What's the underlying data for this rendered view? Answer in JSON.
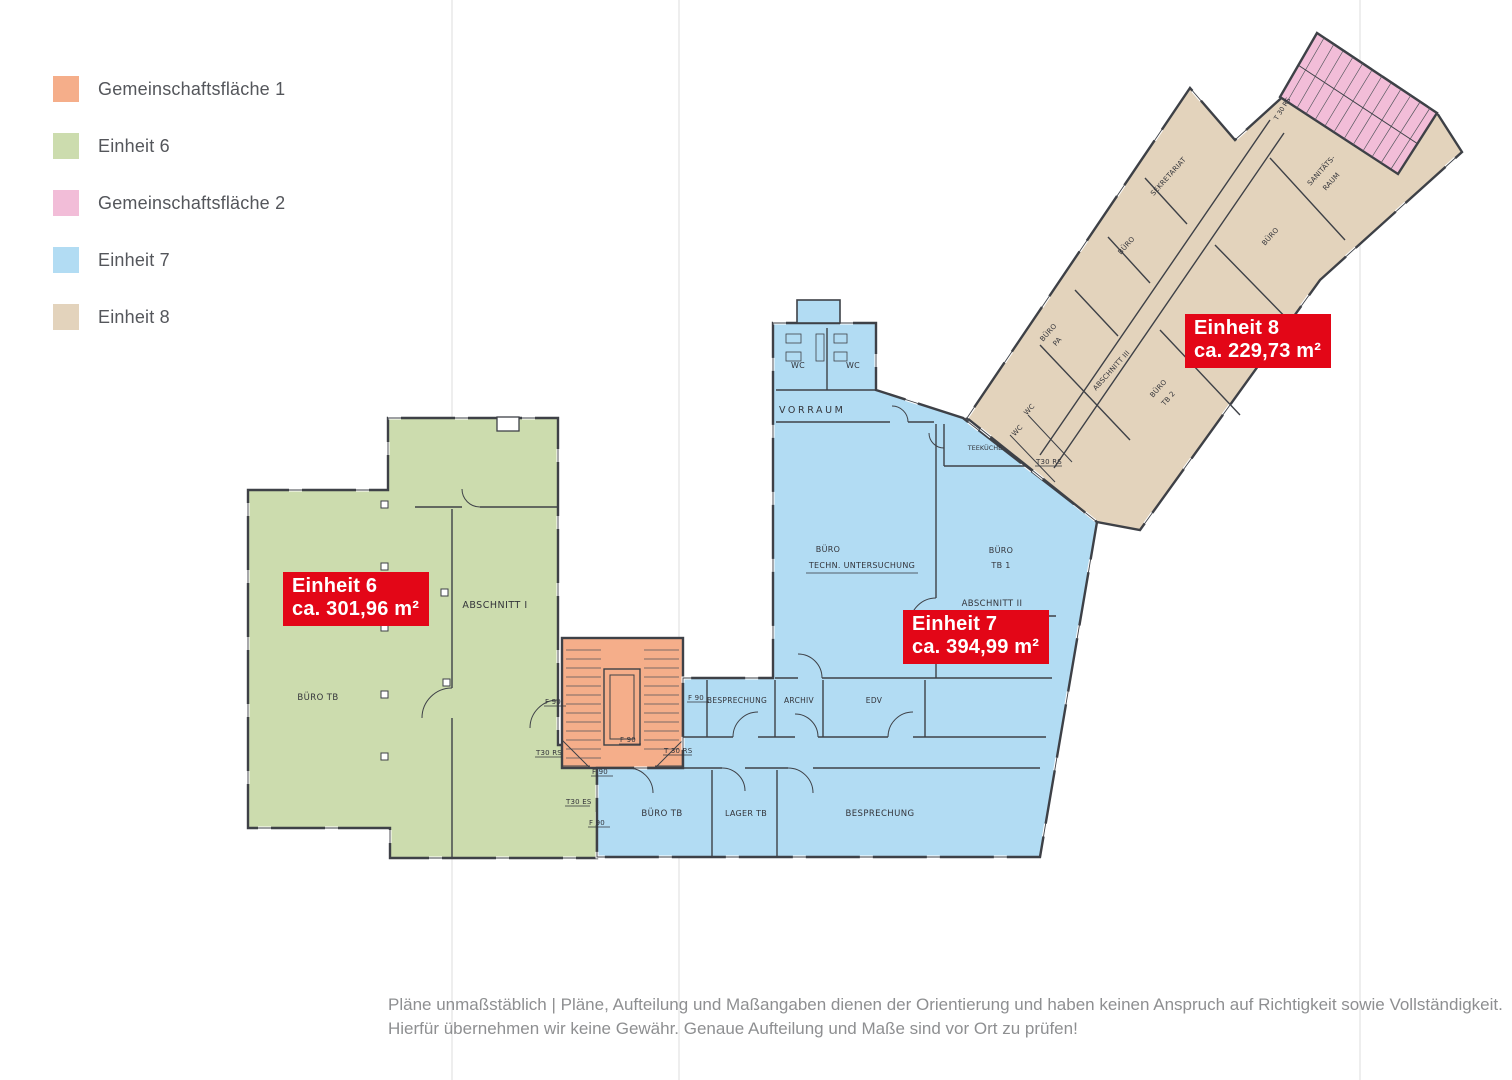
{
  "colors": {
    "red": "#e30617",
    "orange": "#f5ae8a",
    "green": "#ccdcae",
    "pink": "#f2bdd8",
    "blue": "#b2dcf3",
    "beige": "#e3d3bc",
    "wall": "#3e4147"
  },
  "legend": {
    "items": [
      {
        "label": "Gemeinschaftsfläche 1"
      },
      {
        "label": "Einheit 6"
      },
      {
        "label": "Gemeinschaftsfläche 2"
      },
      {
        "label": "Einheit 7"
      },
      {
        "label": "Einheit 8"
      }
    ]
  },
  "units": [
    {
      "name": "Einheit 6",
      "area": "ca. 301,96 m²"
    },
    {
      "name": "Einheit 7",
      "area": "ca. 394,99 m²"
    },
    {
      "name": "Einheit 8",
      "area": "ca. 229,73 m²"
    }
  ],
  "rooms": {
    "wc": "WC",
    "vorraum": "VORRAUM",
    "teekueche": "TEEKÜCHE",
    "buero": "BÜRO",
    "techn_untersuchung": "TECHN. UNTERSUCHUNG",
    "tb1": "TB 1",
    "tb2": "TB 2",
    "pa": "PA",
    "besprechung": "BESPRECHUNG",
    "archiv": "ARCHIV",
    "edv": "EDV",
    "buero_tb": "BÜRO TB",
    "lager_tb": "LAGER TB",
    "sekretariat": "SEKRETARIAT",
    "sanitaets_1": "SANITÄTS-",
    "sanitaets_2": "RAUM",
    "abschnitt_1": "ABSCHNITT I",
    "abschnitt_2": "ABSCHNITT II",
    "abschnitt_3": "ABSCHNITT III",
    "f90": "F 90",
    "t30_rs": "T30 RS",
    "t30_rs_sp": "T 30 RS",
    "t30_es": "T30 ES"
  },
  "footer": {
    "line1": "Pläne unmaßstäblich | Pläne, Aufteilung und Maßangaben dienen der Orientierung und haben keinen Anspruch auf Richtigkeit sowie Vollständigkeit.",
    "line2": "Hierfür übernehmen wir keine Gewähr. Genaue Aufteilung und Maße sind vor Ort zu prüfen!"
  }
}
